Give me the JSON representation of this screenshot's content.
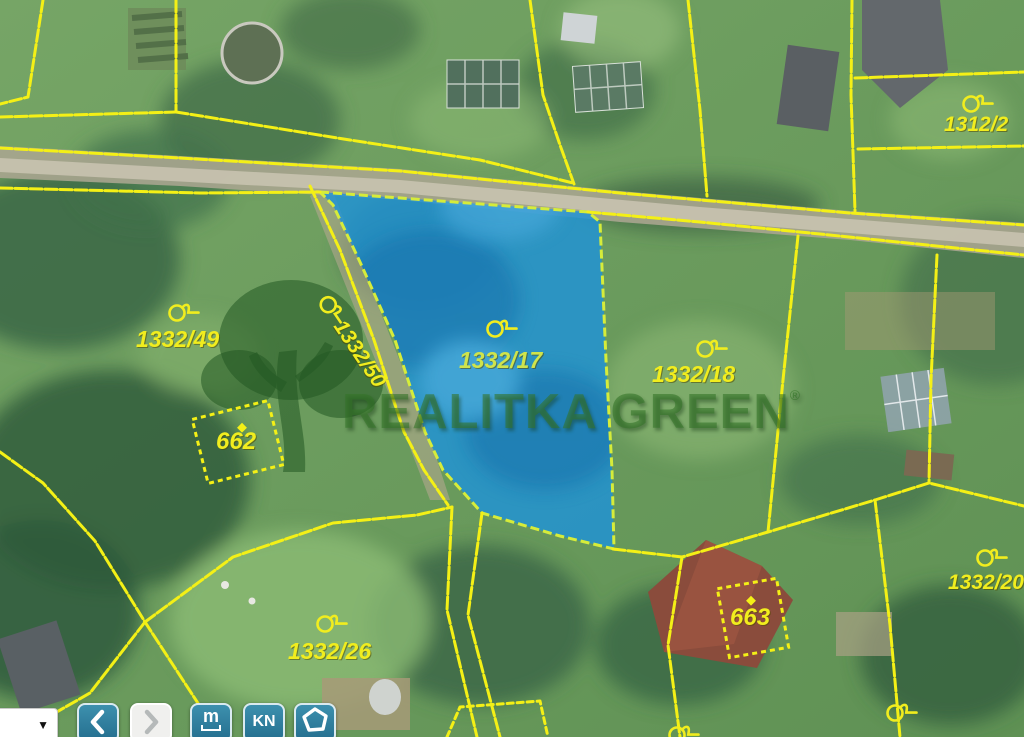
{
  "map": {
    "type": "cadastral-aerial-map",
    "watermark": {
      "text": "REALITKA GREEN",
      "mark": "®"
    },
    "highlighted_parcel": "1332/17",
    "parcels": {
      "p1332_49": {
        "label": "1332/49"
      },
      "p1332_50": {
        "label": "1332/50"
      },
      "p1332_17": {
        "label": "1332/17"
      },
      "p1332_18": {
        "label": "1332/18"
      },
      "p1312_2": {
        "label": "1312/2"
      },
      "p1332_20": {
        "label": "1332/20"
      },
      "p1332_26": {
        "label": "1332/26"
      },
      "p662": {
        "label": "662"
      },
      "p663": {
        "label": "663"
      }
    },
    "colors": {
      "parcel_line": "#f4f016",
      "highlight_fill": "#1f93d8",
      "highlight_edge": "#d6ec3a",
      "label_yellow": "#f1ed1e",
      "watermark_green": "#347328",
      "toolbar_button_blue": "#2b7f9f"
    }
  },
  "toolbar": {
    "scale_select": {
      "caret": "▼"
    },
    "prev_button": {
      "icon": "chevron-left"
    },
    "next_button": {
      "icon": "chevron-right",
      "disabled": true
    },
    "measure": {
      "label": "m"
    },
    "kn": {
      "label": "KN"
    },
    "polygon_tool": {
      "icon": "pentagon"
    }
  }
}
